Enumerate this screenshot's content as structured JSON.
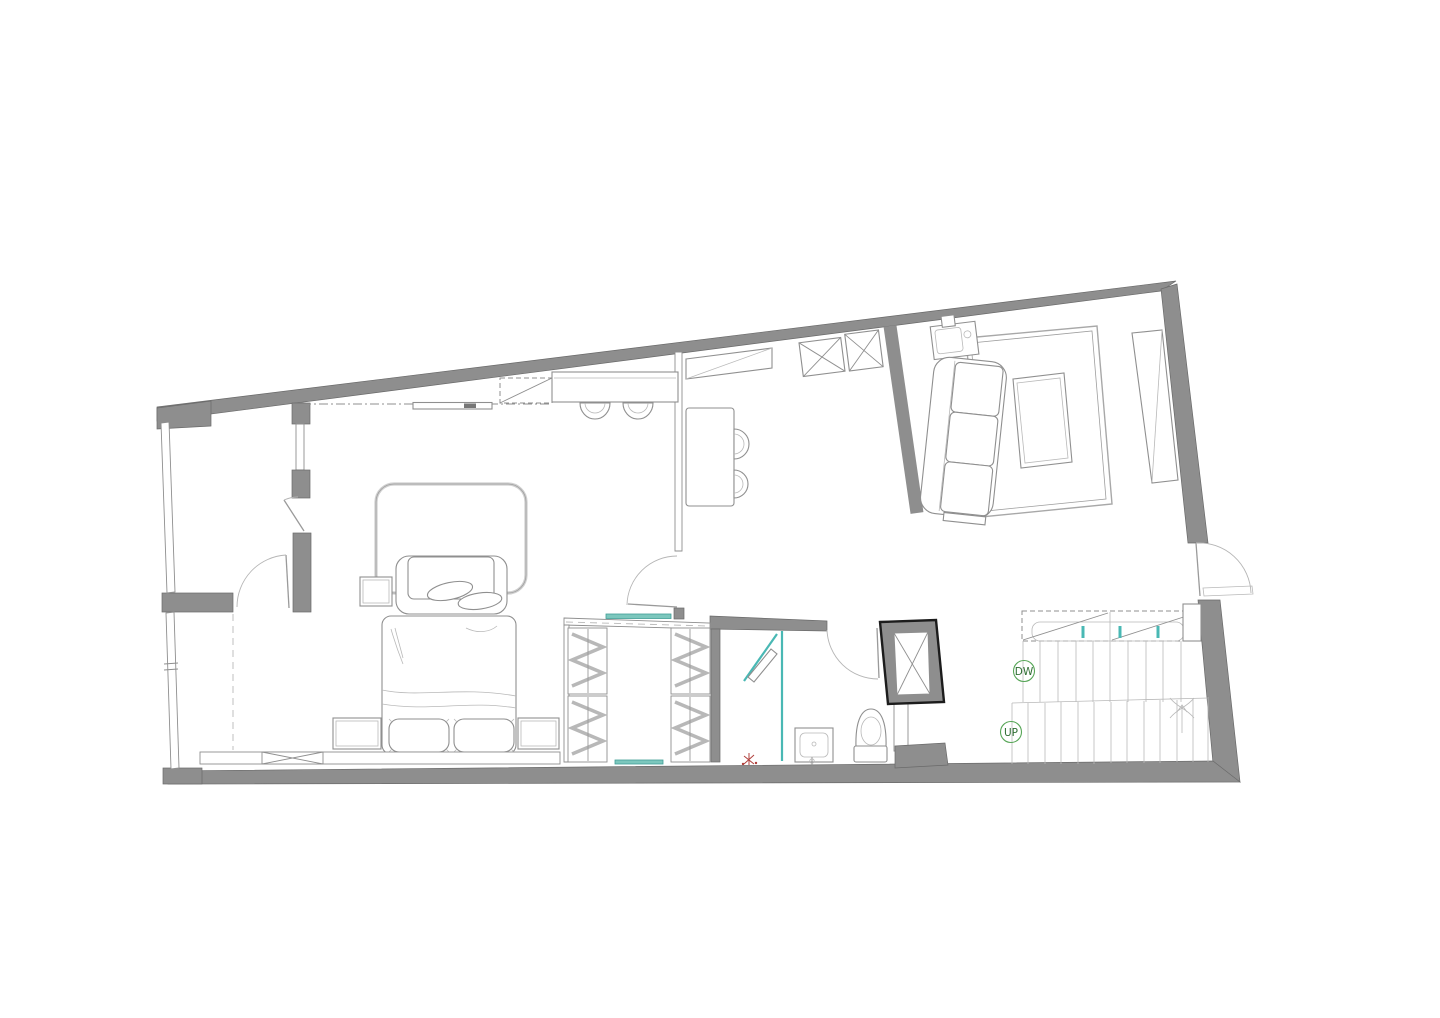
{
  "plan": {
    "labels": {
      "stairs_down": "DW",
      "stairs_up": "UP"
    },
    "colors": {
      "bg": "#ffffff",
      "wall": "#8e8e8e",
      "wall-edge": "#6a6a6a",
      "shaft-edge": "#1c1c1c",
      "line": "#8f8f8f",
      "line-light": "#b9b9b9",
      "teal": "#7cc7bd",
      "teal-stroke": "#3f9e96",
      "teal-line": "#49b8b4",
      "green": "#57a657",
      "green-text": "#2f6e33",
      "red": "#b0403c"
    }
  }
}
